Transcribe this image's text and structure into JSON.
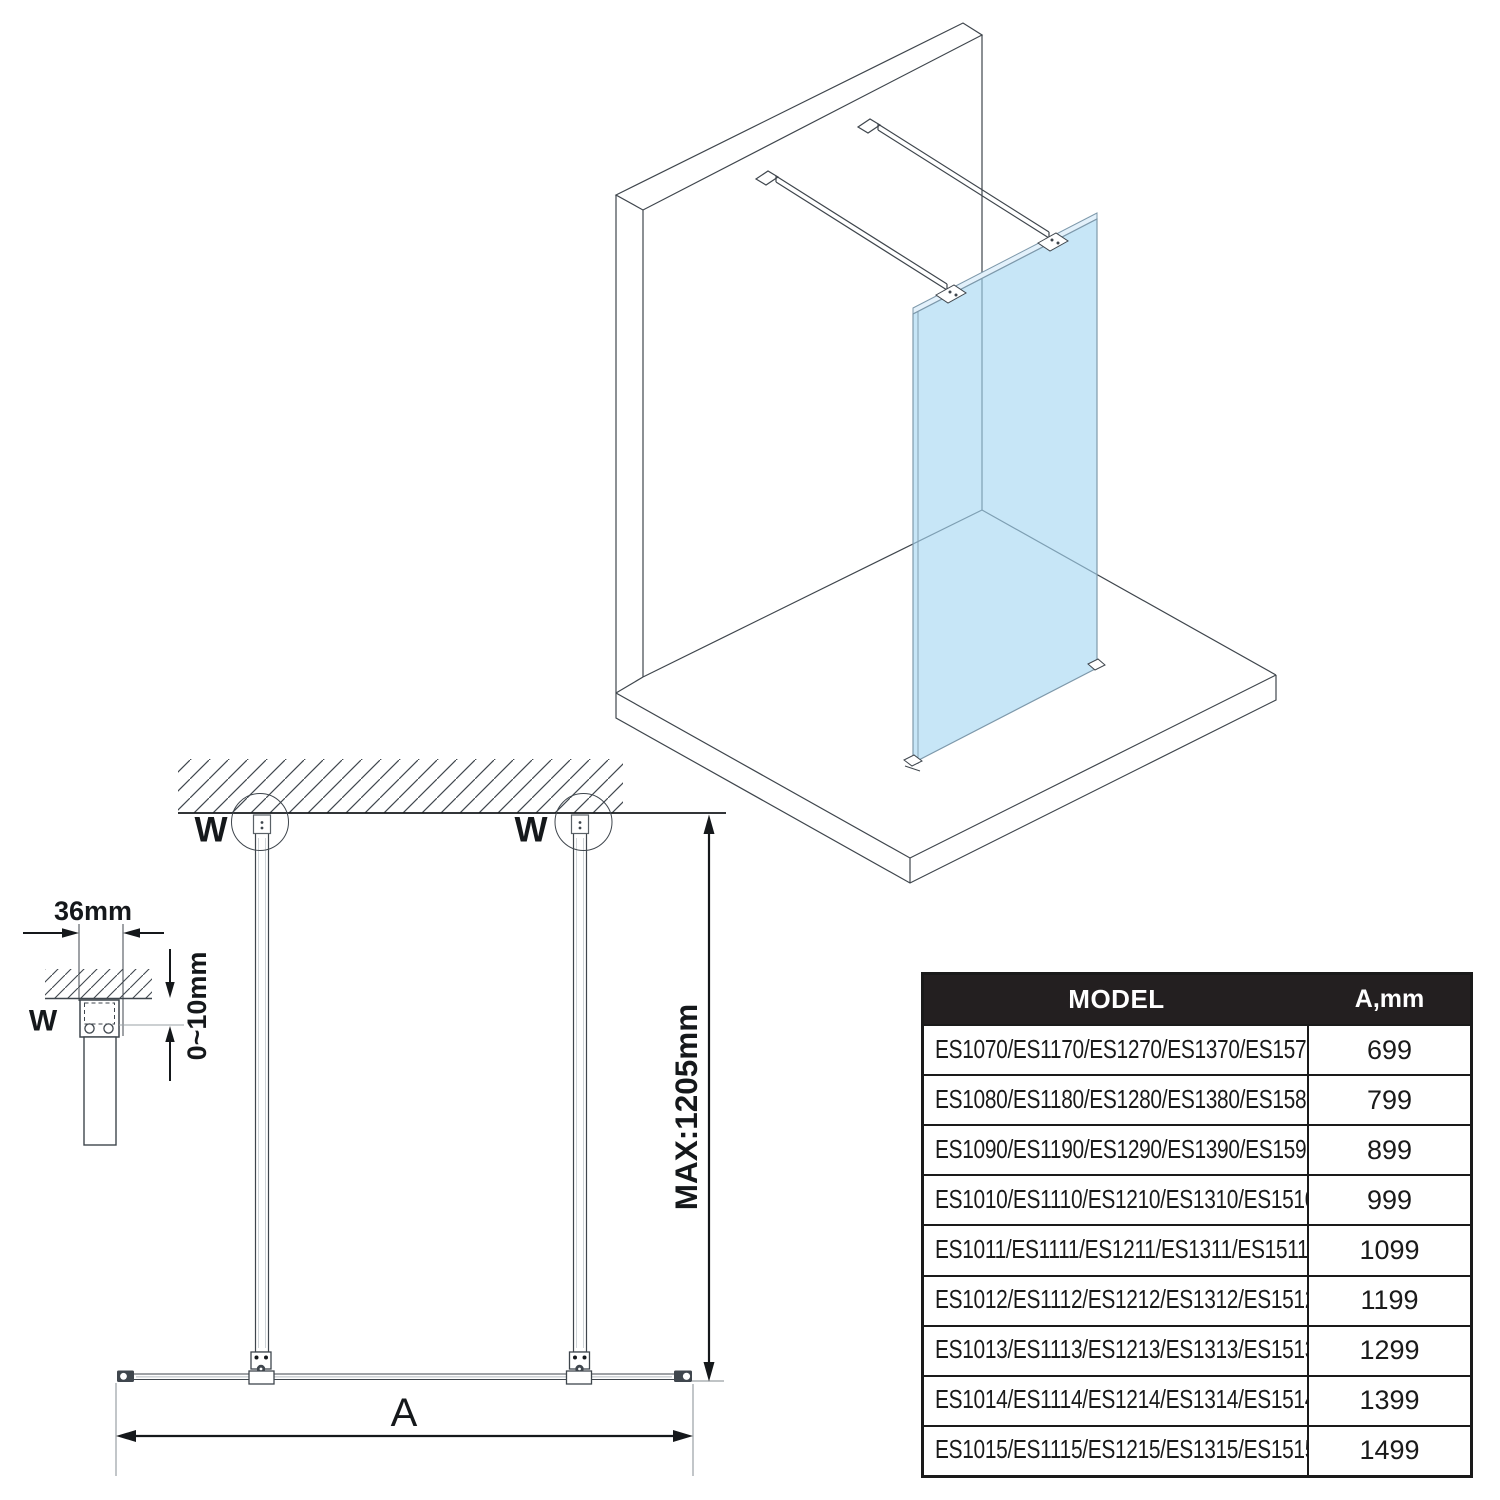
{
  "front_view": {
    "anchor_label_left": "W",
    "anchor_label_right": "W",
    "max_height_label": "MAX:1205mm",
    "width_dim_label": "A"
  },
  "detail_inset": {
    "bar_width_label": "36mm",
    "gap_range_label": "0~10mm",
    "anchor_label": "W"
  },
  "spec_table": {
    "header": {
      "model": "MODEL",
      "dimension": "A,mm"
    },
    "rows": [
      {
        "models": "ES1070/ES1170/ES1270/ES1370/ES1570",
        "a_mm": "699"
      },
      {
        "models": "ES1080/ES1180/ES1280/ES1380/ES1580",
        "a_mm": "799"
      },
      {
        "models": "ES1090/ES1190/ES1290/ES1390/ES1590",
        "a_mm": "899"
      },
      {
        "models": "ES1010/ES1110/ES1210/ES1310/ES1510",
        "a_mm": "999"
      },
      {
        "models": "ES1011/ES1111/ES1211/ES1311/ES1511",
        "a_mm": "1099"
      },
      {
        "models": "ES1012/ES1112/ES1212/ES1312/ES1512",
        "a_mm": "1199"
      },
      {
        "models": "ES1013/ES1113/ES1213/ES1313/ES1513",
        "a_mm": "1299"
      },
      {
        "models": "ES1014/ES1114/ES1214/ES1314/ES1514",
        "a_mm": "1399"
      },
      {
        "models": "ES1015/ES1115/ES1215/ES1315/ES1515",
        "a_mm": "1499"
      }
    ]
  },
  "colors": {
    "glass_fill": "#cce9f8",
    "line": "#3f464d",
    "table_header_bg": "#231f20"
  }
}
